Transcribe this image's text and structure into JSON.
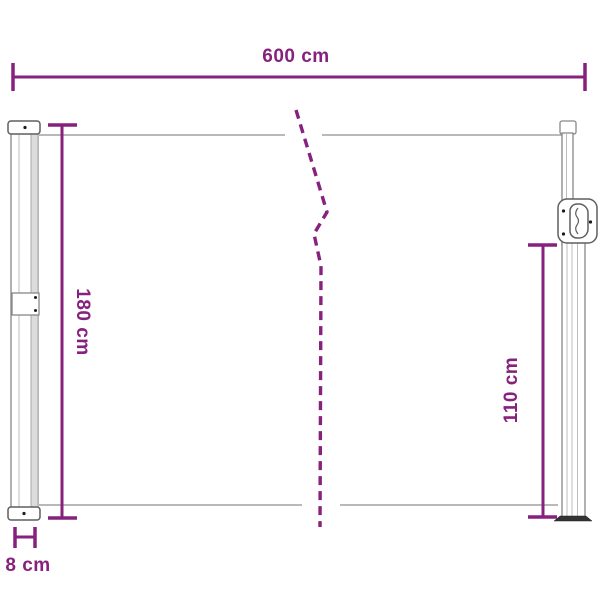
{
  "dimension_labels": {
    "width": "600 cm",
    "height_left": "180 cm",
    "height_right": "110 cm",
    "depth": "8 cm"
  },
  "colors": {
    "dimension": "#86217D",
    "structure": "#8F8F8F",
    "background": "#FFFFFF"
  }
}
